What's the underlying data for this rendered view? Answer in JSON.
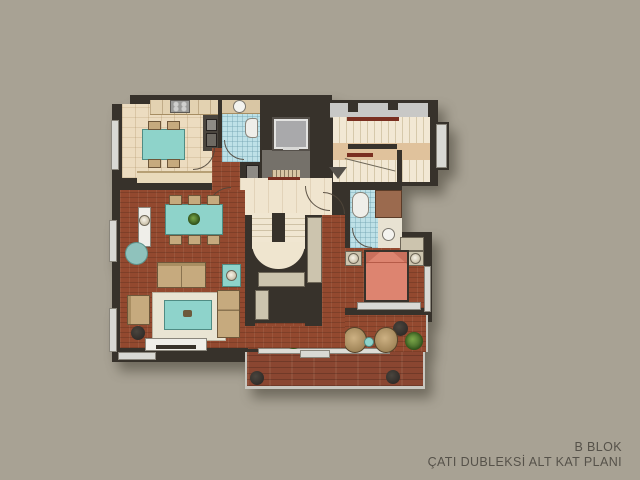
{
  "caption": {
    "block": "B BLOK",
    "plan": "ÇATI DUBLEKSİ ALT KAT PLANI"
  },
  "palette": {
    "background": "#a8a294",
    "walls": "#37322b",
    "parquet_brick": "#93492f",
    "terrace_deck": "#8a4631",
    "kitchen_tile": "#ecdcc0",
    "bath_tile": "#bee1e7",
    "stair_cream": "#f2e8d4",
    "landing_tan": "#e0c29c",
    "handrail_red": "#7a2f20",
    "accent_teal": "#8ed3ca",
    "furniture_tan": "#c6aa7e",
    "bed_salmon": "#dd8470",
    "elevator_gray": "#a9a9ab",
    "facade_gray": "#c8c8c6",
    "caption_text": "#56524a"
  }
}
